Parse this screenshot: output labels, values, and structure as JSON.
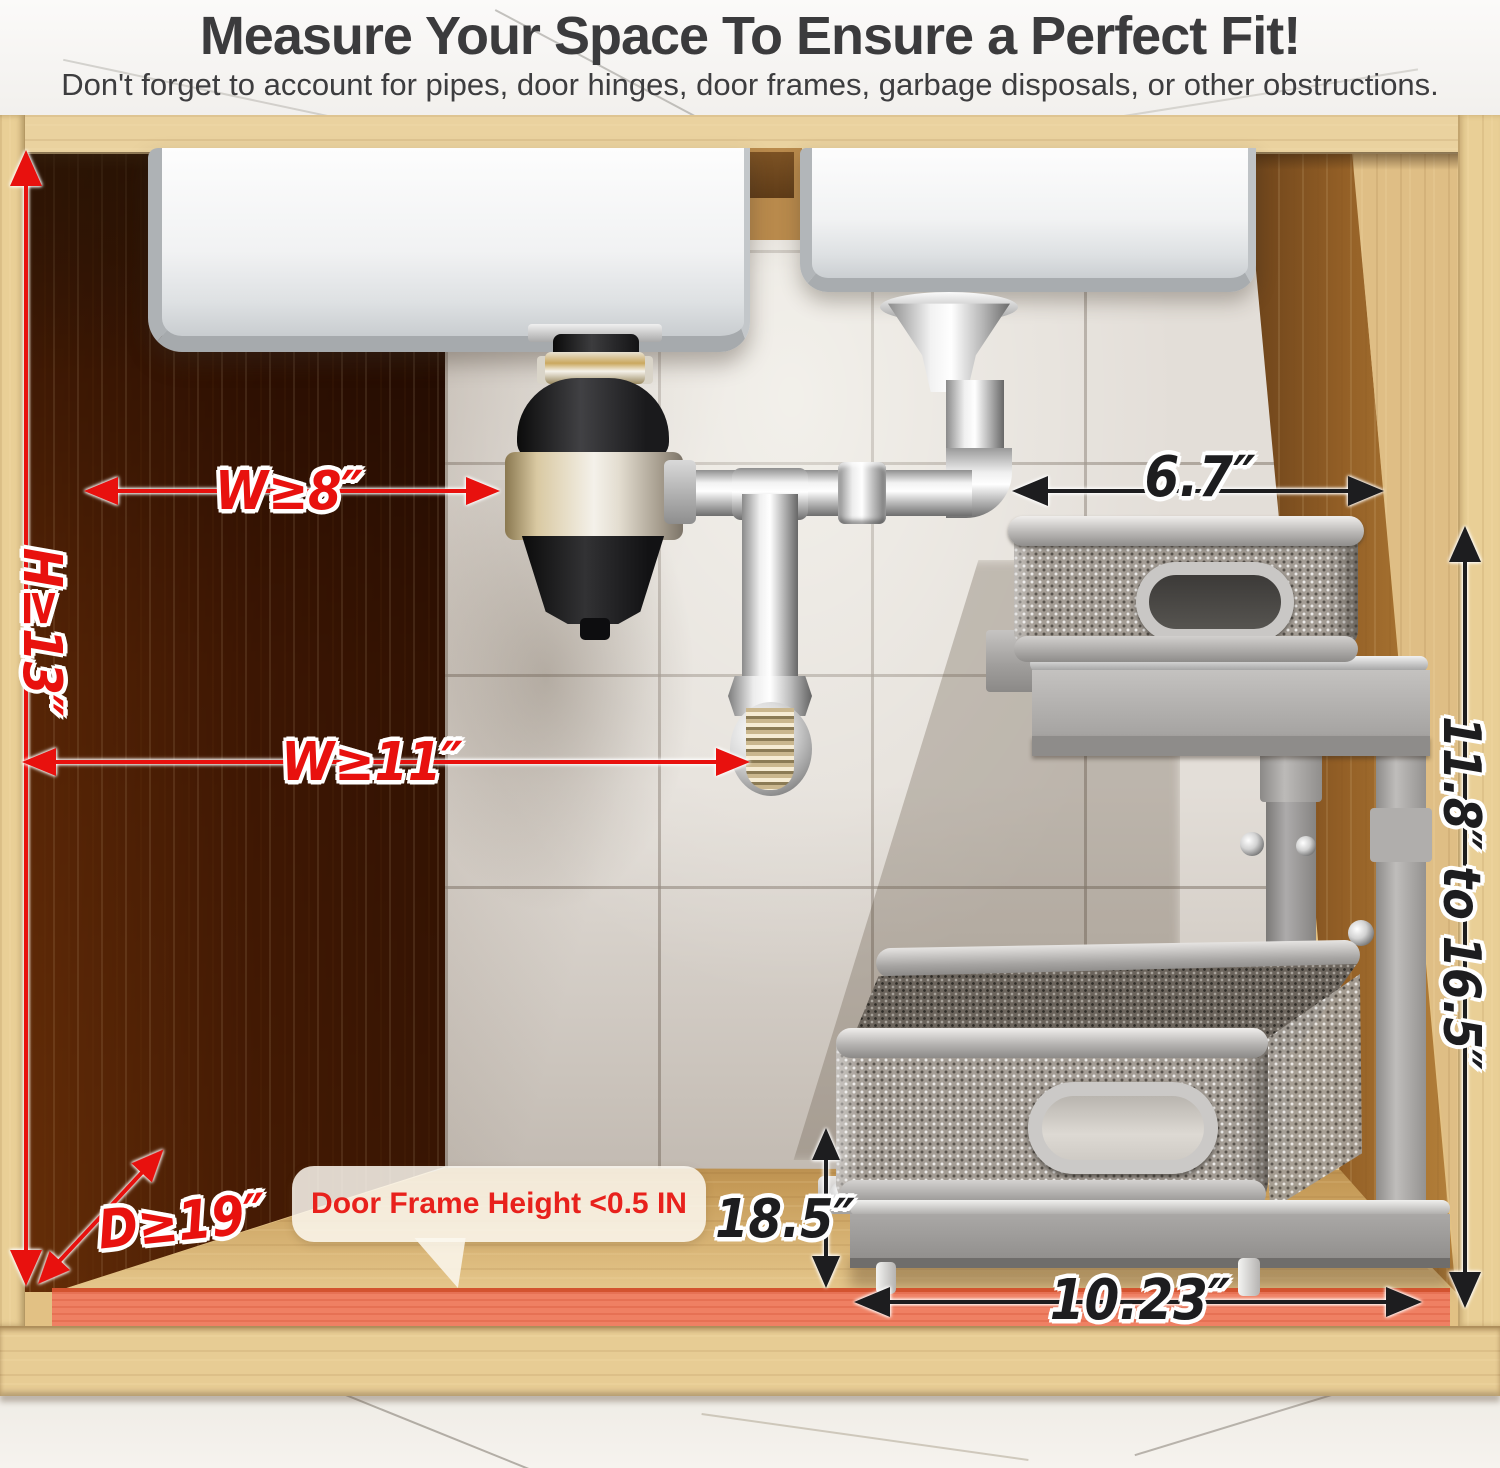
{
  "header": {
    "title": "Measure Your Space To Ensure a Perfect Fit!",
    "subtitle": "Don't forget to account for pipes, door hinges, door frames, garbage disposals, or other obstructions."
  },
  "annotations": {
    "cabinet_height": "H≥13″",
    "width_at_disposal": "W≥8″",
    "width_at_pipe": "W≥11″",
    "cabinet_depth": "D≥19″",
    "upper_shelf_width": "6.7″",
    "adjustable_height": "11.8″ to 16.5″",
    "lower_clearance": "18.5″",
    "base_width": "10.23″",
    "door_frame_note": "Door Frame Height <0.5 IN"
  },
  "colors": {
    "dimension_red": "#e8110e",
    "dimension_black": "#1d1d1f",
    "door_seal_orange": "#ef8063",
    "cabinet_wood": "#e2c184",
    "tile_wall": "#e3ded8"
  }
}
